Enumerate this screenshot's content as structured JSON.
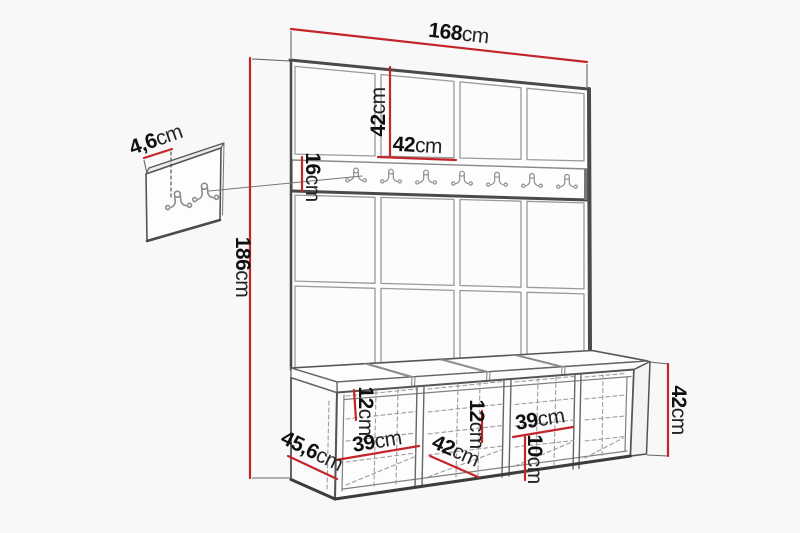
{
  "drawing_type": "furniture dimension diagram (hallway set: wall panel with coat hooks and storage bench)",
  "colors": {
    "background": "#f8f8f8",
    "dimension_line": "#c4252b",
    "outline_dark": "#4a4a4a",
    "outline_mid": "#888888",
    "hidden_line": "#9c9c9c",
    "label_text": "#141414"
  },
  "hooks": {
    "rail_hook_count": 7,
    "detail_panel_hook_count": 2,
    "icon": "double-prong-coat-hook"
  },
  "dims": {
    "width_total": {
      "num": "168",
      "unit": "cm"
    },
    "height_total": {
      "num": "186",
      "unit": "cm"
    },
    "tile_h": {
      "num": "42",
      "unit": "cm"
    },
    "tile_w": {
      "num": "42",
      "unit": "cm"
    },
    "rail_h": {
      "num": "16",
      "unit": "cm"
    },
    "hook_plate": {
      "num": "4,6",
      "unit": "cm"
    },
    "bench_depth": {
      "num": "45,6",
      "unit": "cm"
    },
    "bench_h": {
      "num": "42",
      "unit": "cm"
    },
    "comp1_w": {
      "num": "39",
      "unit": "cm"
    },
    "comp2_w": {
      "num": "42",
      "unit": "cm"
    },
    "comp3_w": {
      "num": "39",
      "unit": "cm"
    },
    "shelf_left": {
      "num": "12",
      "unit": "cm"
    },
    "shelf_mid": {
      "num": "12",
      "unit": "cm"
    },
    "shelf_right": {
      "num": "10",
      "unit": "cm"
    }
  }
}
